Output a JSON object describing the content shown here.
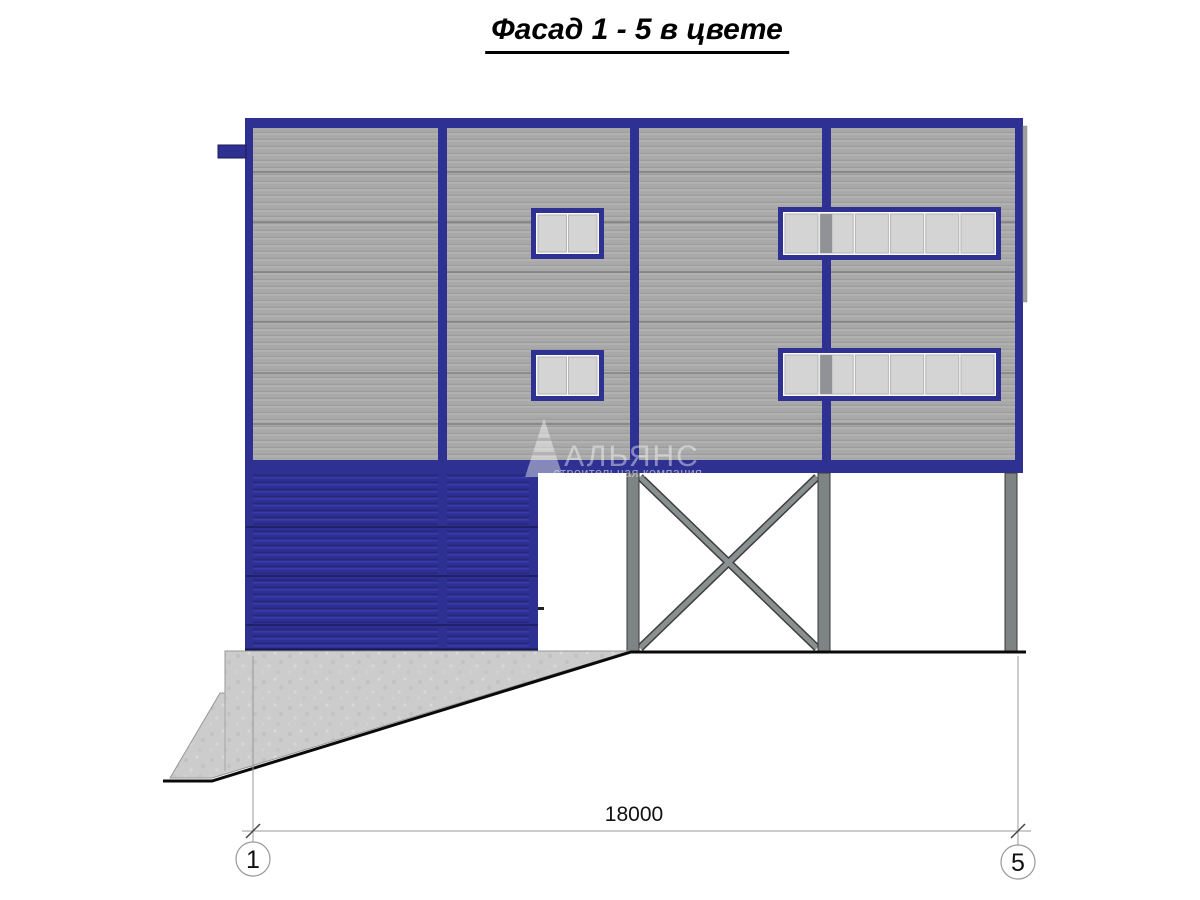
{
  "title": {
    "text": "Фасад 1 - 5 в цвете"
  },
  "watermark": {
    "logo_text": "АЛЬЯНС",
    "subtitle": "строительная компания"
  },
  "dimension": {
    "value": "18000",
    "axis_left": "1",
    "axis_right": "5"
  },
  "colors": {
    "frame_blue": "#2e3192",
    "panel_gray": "#a9a9a9",
    "door_blue": "#2d2e96",
    "window_pane_gray": "#d4d4d4",
    "column_gray": "#7e8484",
    "concrete_gray": "#cccccc",
    "ground_line_black": "#0a0a0a"
  }
}
